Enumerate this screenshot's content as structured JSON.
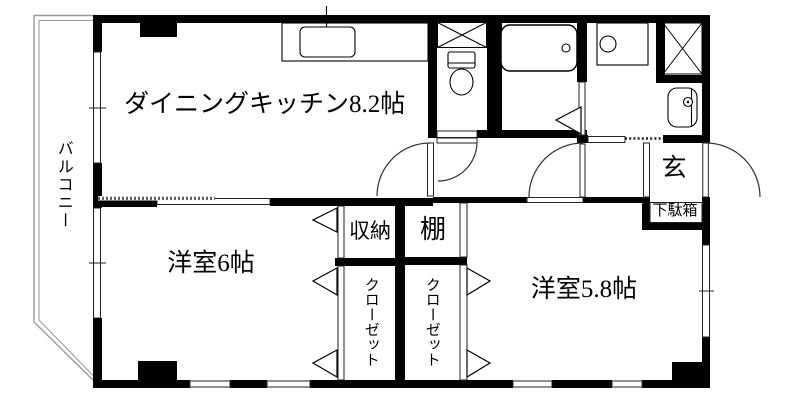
{
  "floorplan": {
    "labels": {
      "balcony": "バルコニー",
      "dining_kitchen": "ダイニングキッチン8.2帖",
      "western_room_6": "洋室6帖",
      "western_room_5_8": "洋室5.8帖",
      "storage": "収納",
      "shelf": "棚",
      "closet_left": "クローゼット",
      "closet_right": "クローゼット",
      "entrance": "玄",
      "shoe_cabinet": "下駄箱"
    },
    "colors": {
      "wall": "#000000",
      "thin_line": "#222222",
      "balcony_line": "#999999",
      "background": "#ffffff"
    }
  }
}
